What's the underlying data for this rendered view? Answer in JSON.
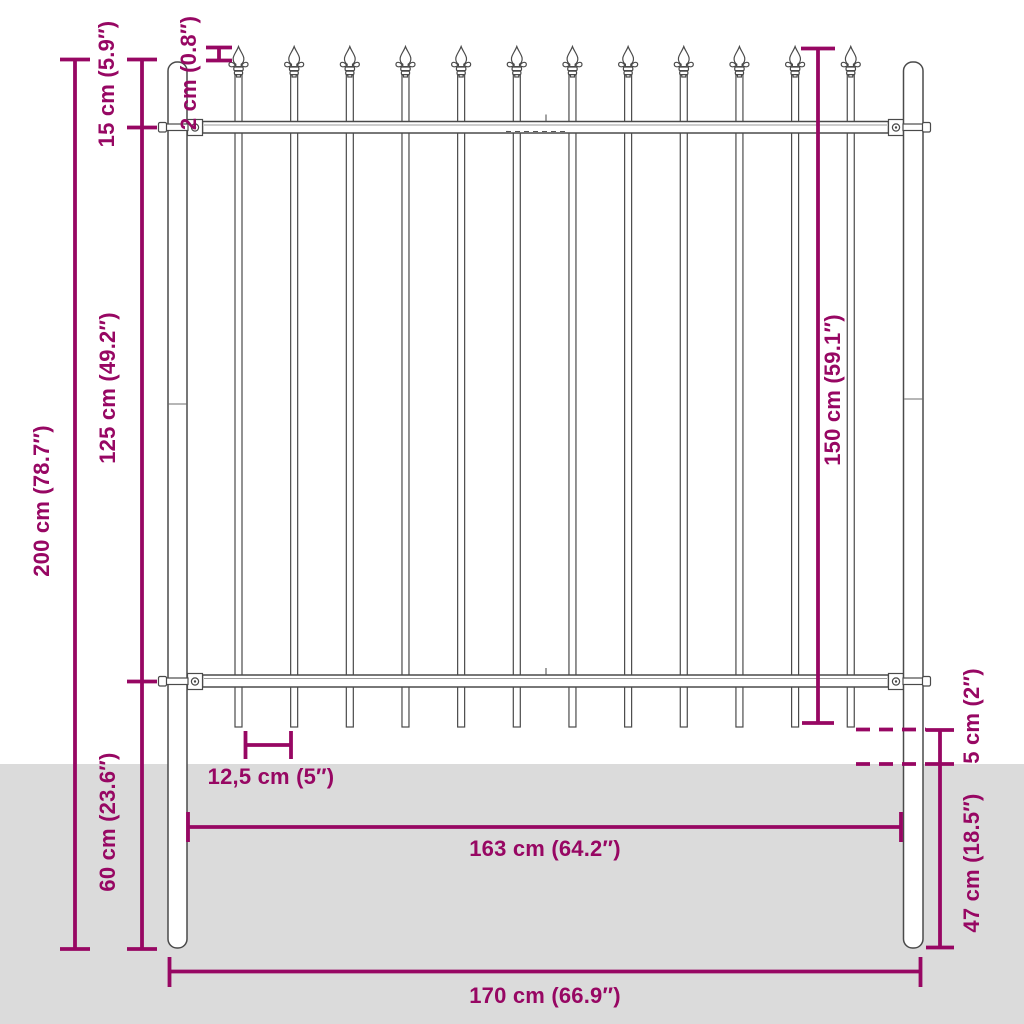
{
  "colors": {
    "dimension": "#970763",
    "outline": "#4A4A4A",
    "ground": "#DBDBDB",
    "metal_fill": "#FFFFFF"
  },
  "fence": {
    "bar_count": 12,
    "rail_count": 2,
    "post_count": 2
  },
  "labels": {
    "total_height": "200 cm (78.7″)",
    "top_offset": "15 cm (5.9″)",
    "panel_height": "125 cm (49.2″)",
    "ground_depth": "60 cm (23.6″)",
    "bar_top": "2 cm (0.8″)",
    "bar_height": "150 cm (59.1″)",
    "bar_spacing": "12,5 cm (5″)",
    "ground_clearance": "5 cm (2″)",
    "post_below_ground": "47 cm (18.5″)",
    "inner_width": "163 cm (64.2″)",
    "total_width": "170 cm (66.9″)"
  }
}
